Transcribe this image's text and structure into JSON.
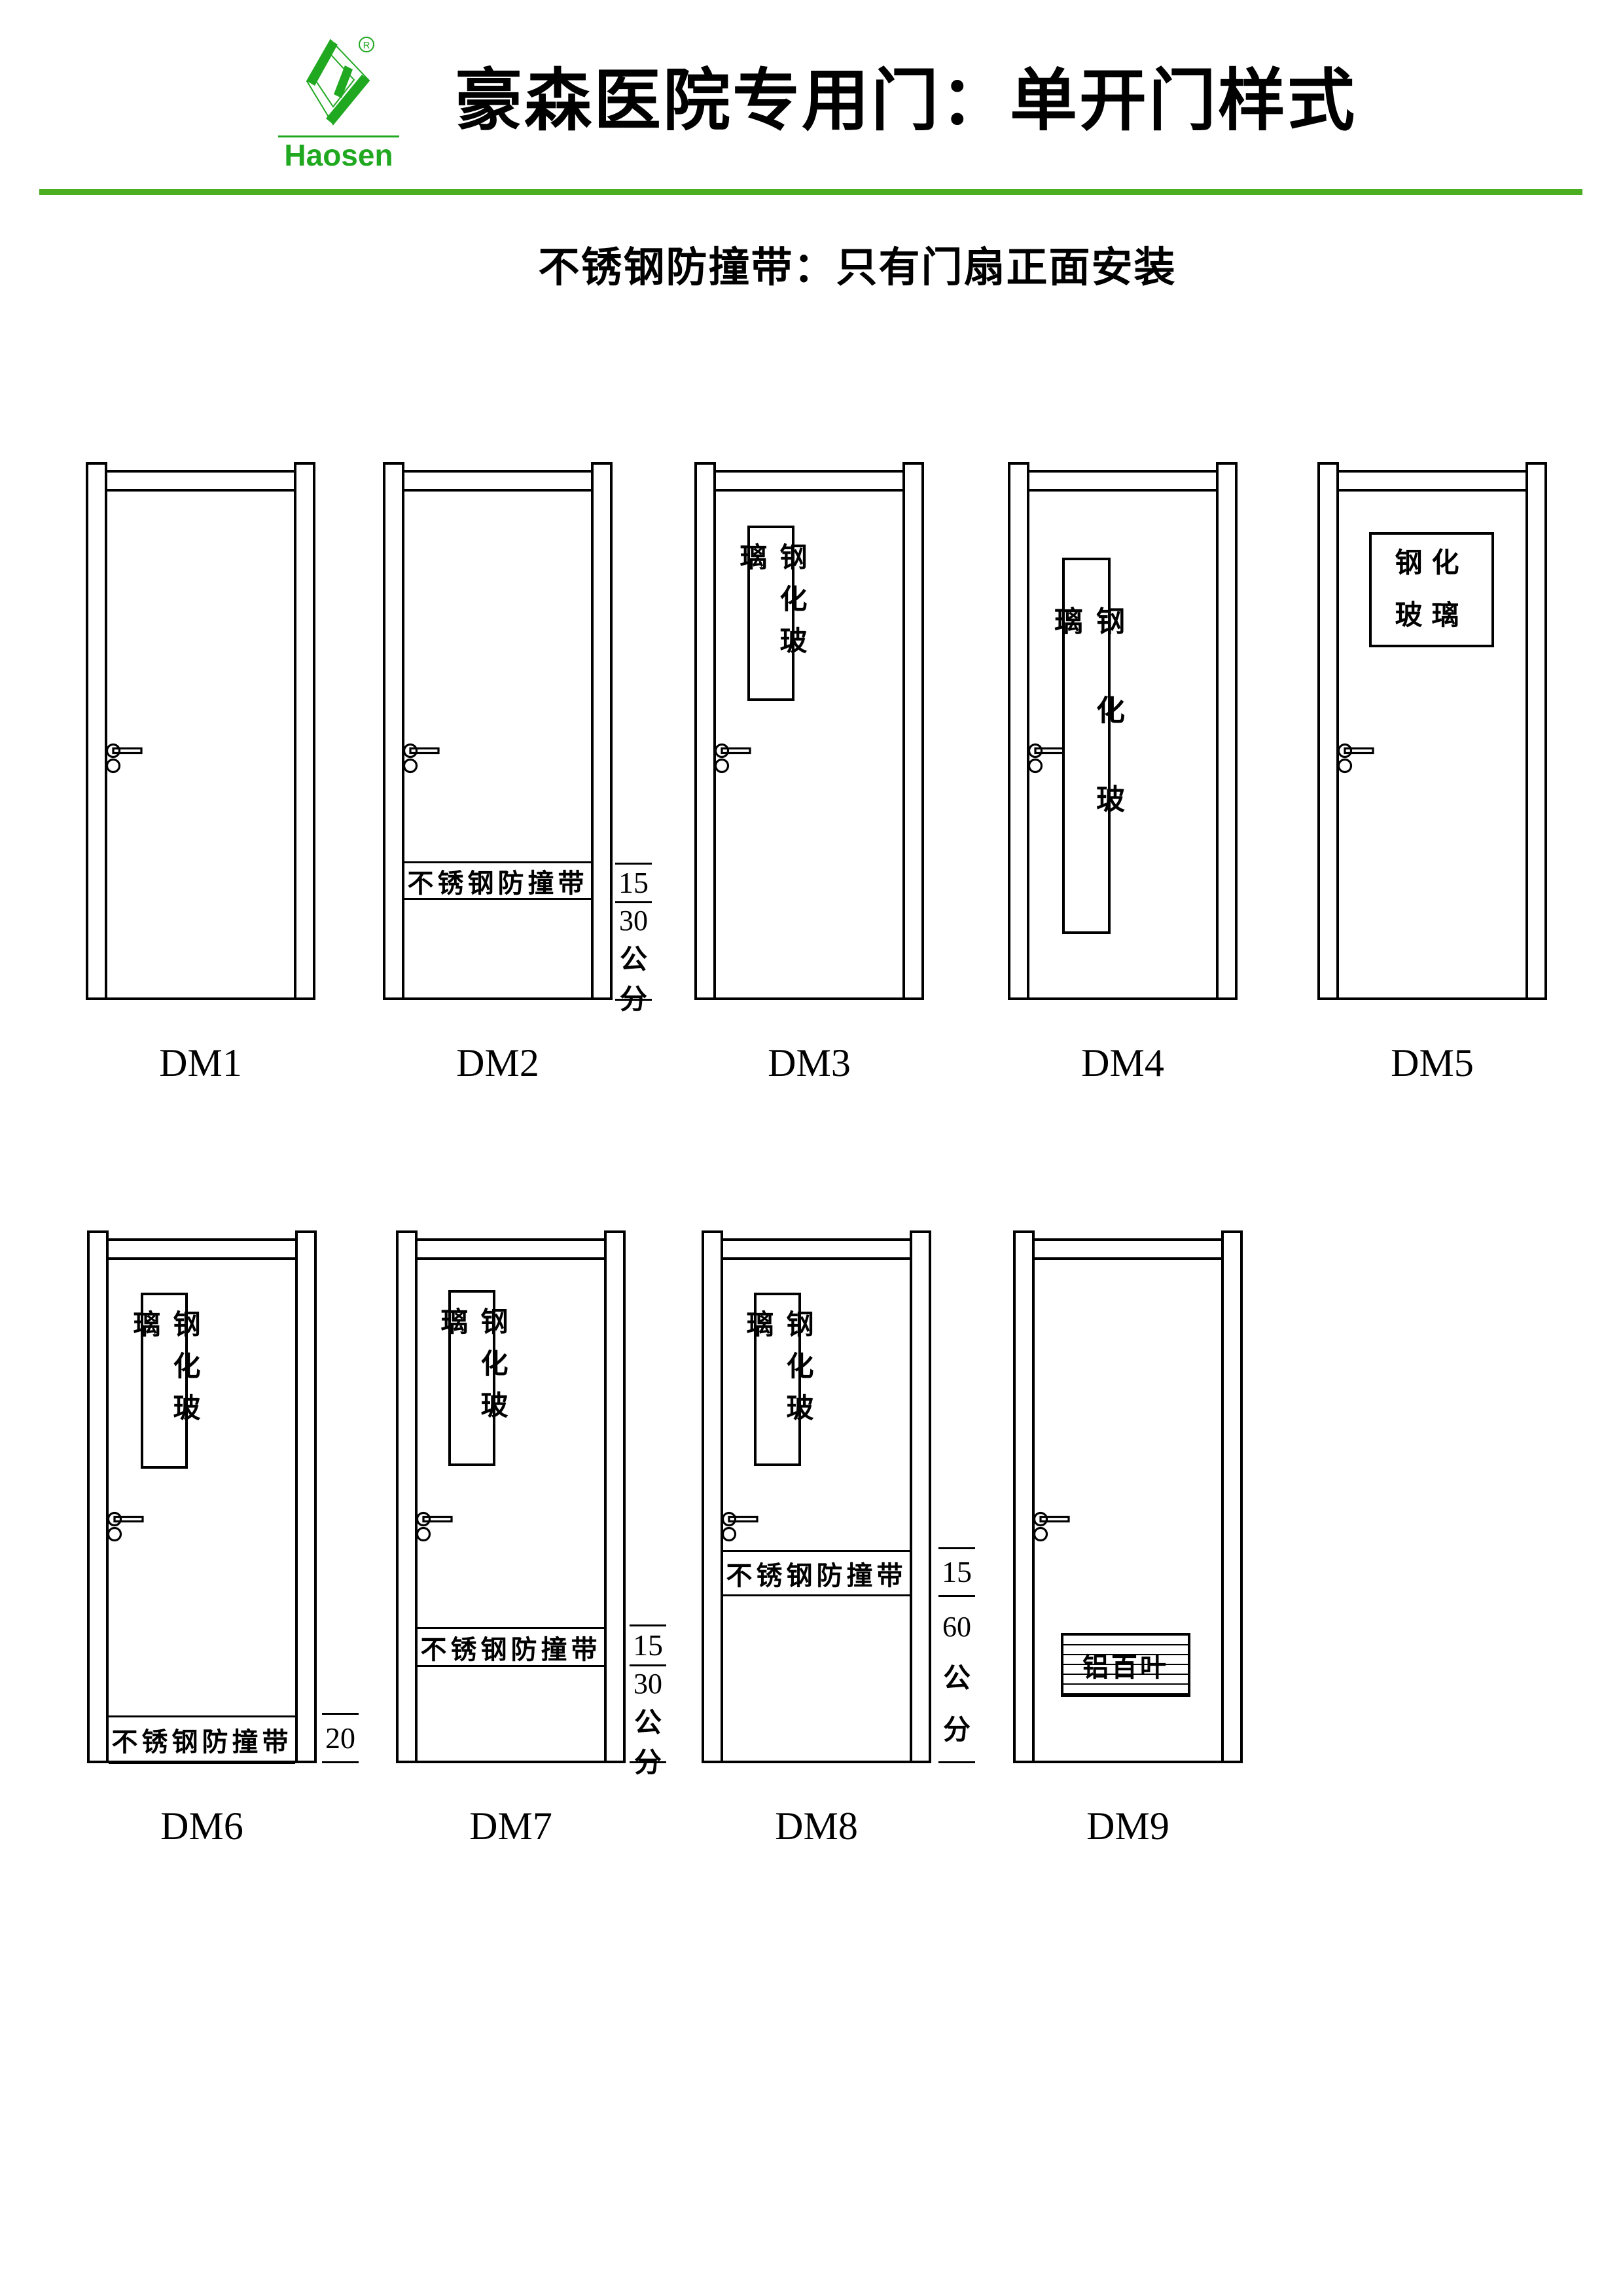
{
  "brand": {
    "name": "Haosen",
    "registered_mark": "®",
    "logo_green": "#21a821",
    "separator_green": "#4bae22"
  },
  "header": {
    "title": "豪森医院专用门：单开门样式",
    "subtitle": "不锈钢防撞带：只有门扇正面安装"
  },
  "doors": {
    "dm1": {
      "label": "DM1"
    },
    "dm2": {
      "label": "DM2",
      "strip_text": "不锈钢防撞带"
    },
    "dm3": {
      "label": "DM3",
      "glass_text": "钢化玻璃"
    },
    "dm4": {
      "label": "DM4",
      "glass_text": "钢化玻璃"
    },
    "dm5": {
      "label": "DM5",
      "glass_line1": "钢化",
      "glass_line2": "玻璃"
    },
    "dm6": {
      "label": "DM6",
      "glass_text": "钢化玻璃",
      "strip_text": "不锈钢防撞带"
    },
    "dm7": {
      "label": "DM7",
      "glass_text": "钢化玻璃",
      "strip_text": "不锈钢防撞带"
    },
    "dm8": {
      "label": "DM8",
      "glass_text": "钢化玻璃",
      "strip_text": "不锈钢防撞带"
    },
    "dm9": {
      "label": "DM9",
      "louver_text": "铝百叶"
    }
  },
  "dims": {
    "dm2": {
      "strip_height": "15",
      "offset": "30",
      "unit_char1": "公",
      "unit_char2": "分"
    },
    "dm6": {
      "strip_height": "20"
    },
    "dm7": {
      "strip_height": "15",
      "offset": "30",
      "unit_char1": "公",
      "unit_char2": "分"
    },
    "dm8": {
      "strip_height": "15",
      "offset": "60",
      "unit_char1": "公",
      "unit_char2": "分"
    }
  }
}
